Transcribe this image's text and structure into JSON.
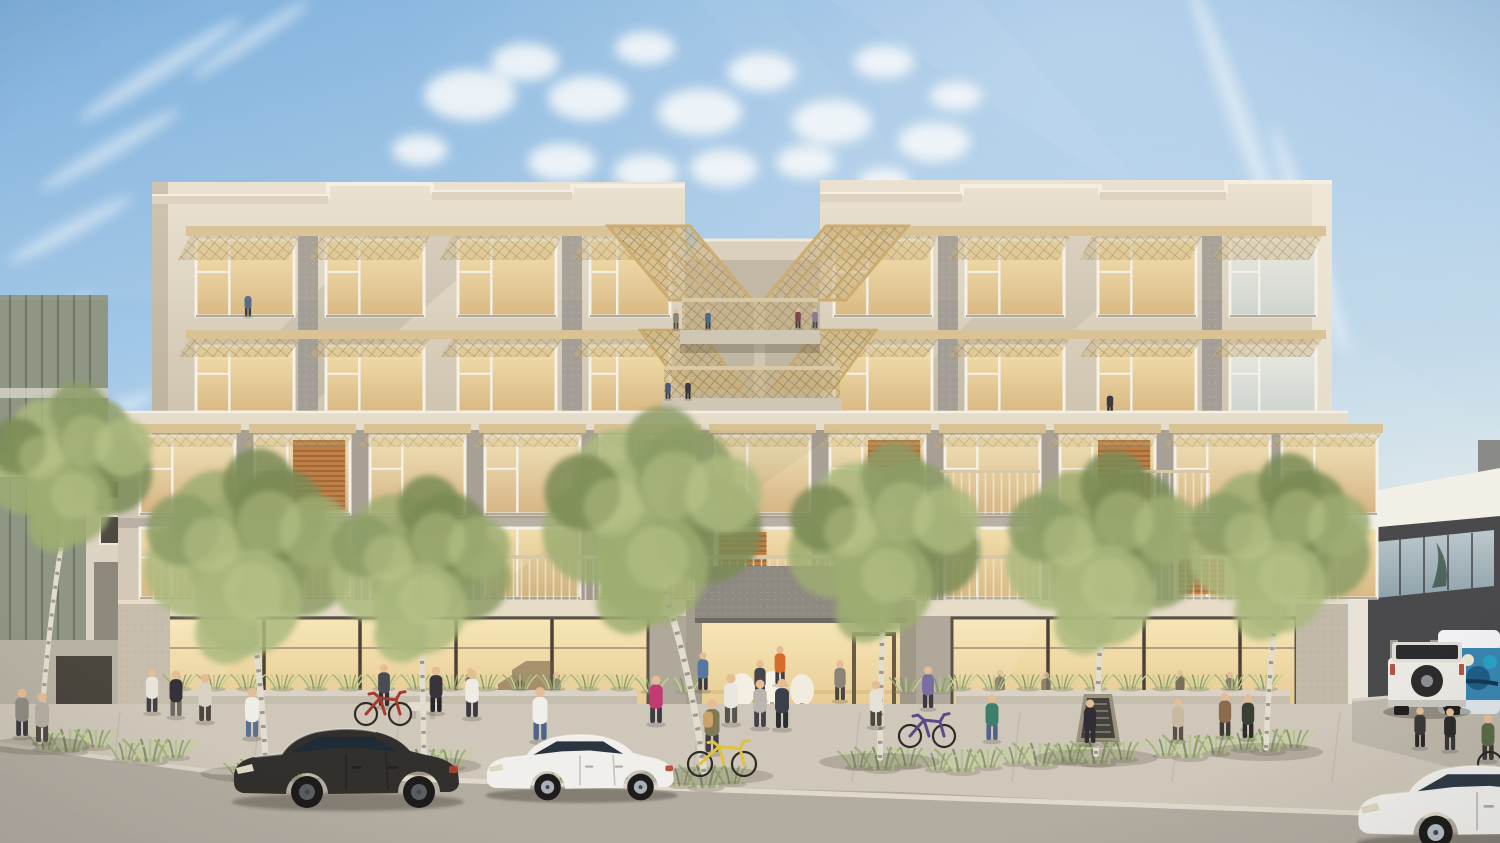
{
  "meta": {
    "caption": "Street-level architectural rendering of a modern five-story mixed-use apartment building with street trees, pedestrians, cyclists and parked cars",
    "width": 1500,
    "height": 843
  },
  "palette": {
    "sky_top": "#74abdc",
    "sky_mid": "#a5c9e8",
    "sky_horizon": "#e9e2d4",
    "cloud": "#f8fbfd",
    "beige_light": "#e9e1d1",
    "beige": "#d6cab6",
    "beige_shade": "#c3b7a2",
    "gray_panel": "#a49f96",
    "gray_dark": "#8e8980",
    "podium": "#a8a095",
    "awning_tan": "#d9c294",
    "mesh_tan": "#c9b17c",
    "frame_white": "#f4f1e8",
    "window_warm_hi": "#f2dfae",
    "window_warm_lo": "#d9b983",
    "wood_louver": "#bf7f46",
    "storefront_glow": "#f6e3b0",
    "sidewalk": "#cfc7b9",
    "road": "#b3aca1",
    "curb": "#e0d9cb",
    "tree_greens": [
      "#8c9c66",
      "#9dad72",
      "#7a8b55",
      "#aab87e"
    ],
    "tree_highlight": "#c2cc92",
    "birch_trunk": "#e3ddd0",
    "birch_mark": "#57524a",
    "grass_sage": "#a9ba85",
    "car_black": "#32302d",
    "car_white": "#f0efeb",
    "bike_yellow": "#e0c23c",
    "bike_red": "#a83a2c",
    "bike_purple": "#5b4a8a",
    "van_graffiti": "#3a86b0",
    "neighbor_dark": "#47474a",
    "vest_orange": "#d86a2a"
  },
  "scene": {
    "architecture": {
      "upper_wings": [
        {
          "name": "left-wing",
          "bays": [
            [
              190,
              110
            ],
            [
              320,
              110
            ],
            [
              452,
              110
            ],
            [
              584,
              92
            ]
          ]
        },
        {
          "name": "right-wing",
          "bays": [
            [
              828,
              110
            ],
            [
              960,
              110
            ],
            [
              1092,
              110
            ],
            [
              1224,
              98
            ]
          ]
        }
      ],
      "floor5": {
        "y": 240,
        "h": 76
      },
      "floor4": {
        "y": 346,
        "h": 66
      },
      "podium_bays": [
        140,
        255,
        370,
        485,
        600,
        715,
        830,
        945,
        1060,
        1175,
        1282
      ],
      "bay_w": 95,
      "floor3": {
        "y": 436,
        "h": 78,
        "louvers": [
          1,
          4,
          6,
          8
        ]
      },
      "floor2": {
        "y": 528,
        "h": 70,
        "louvers": [
          2,
          5,
          9
        ]
      },
      "storefronts": [
        [
          168,
          648
        ],
        [
          952,
          1296
        ]
      ]
    },
    "clouds": [
      [
        470,
        95,
        46
      ],
      [
        525,
        62,
        34
      ],
      [
        588,
        98,
        40
      ],
      [
        645,
        48,
        30
      ],
      [
        700,
        112,
        42
      ],
      [
        762,
        72,
        34
      ],
      [
        832,
        122,
        40
      ],
      [
        884,
        62,
        30
      ],
      [
        934,
        142,
        36
      ],
      [
        562,
        162,
        34
      ],
      [
        646,
        172,
        32
      ],
      [
        724,
        168,
        34
      ],
      [
        806,
        162,
        30
      ],
      [
        884,
        182,
        26
      ],
      [
        956,
        96,
        26
      ],
      [
        420,
        150,
        28
      ]
    ],
    "wisps": [
      [
        160,
        70,
        95,
        9,
        -32
      ],
      [
        110,
        150,
        80,
        8,
        -30
      ],
      [
        70,
        230,
        70,
        8,
        -28
      ],
      [
        250,
        40,
        70,
        7,
        -33
      ],
      [
        1240,
        120,
        150,
        10,
        70
      ],
      [
        1310,
        240,
        120,
        9,
        72
      ],
      [
        40,
        320,
        60,
        7,
        -25
      ],
      [
        90,
        420,
        70,
        8,
        -22
      ]
    ],
    "trees": [
      [
        70,
        470,
        84,
        40,
        742,
        0
      ],
      [
        248,
        560,
        106,
        266,
        770,
        1
      ],
      [
        420,
        572,
        92,
        424,
        762,
        0
      ],
      [
        652,
        524,
        112,
        704,
        772,
        1
      ],
      [
        884,
        546,
        98,
        880,
        758,
        0
      ],
      [
        1104,
        556,
        100,
        1096,
        754,
        1
      ],
      [
        1280,
        550,
        92,
        1266,
        748,
        0
      ]
    ],
    "grass_clumps": [
      [
        150,
        762
      ],
      [
        268,
        782
      ],
      [
        425,
        772
      ],
      [
        588,
        782
      ],
      [
        706,
        788
      ],
      [
        882,
        770
      ],
      [
        1040,
        766
      ],
      [
        1098,
        764
      ],
      [
        1190,
        758
      ],
      [
        1268,
        752
      ],
      [
        70,
        752
      ],
      [
        962,
        772
      ],
      [
        330,
        770
      ]
    ],
    "planter_rows": [
      [
        180,
        636,
        689
      ],
      [
        960,
        1288,
        689
      ],
      [
        652,
        698,
        692
      ],
      [
        906,
        948,
        692
      ]
    ],
    "people": [
      [
        22,
        736,
        50,
        "#8f8c84",
        "#3d3c40"
      ],
      [
        42,
        742,
        52,
        "#b5afa2",
        "#514c46"
      ],
      [
        152,
        712,
        46,
        "#e9e4da",
        "#403f45"
      ],
      [
        176,
        716,
        48,
        "#33323a",
        "#6e6960"
      ],
      [
        205,
        721,
        50,
        "#d9d2c3",
        "#4b4641"
      ],
      [
        252,
        737,
        52,
        "#f0ede5",
        "#5b7191"
      ],
      [
        436,
        712,
        48,
        "#37343c",
        "#26262c"
      ],
      [
        472,
        717,
        50,
        "#efece5",
        "#3b3b41"
      ],
      [
        540,
        740,
        56,
        "#f1efe9",
        "#50648a"
      ],
      [
        656,
        723,
        50,
        "#c23a72",
        "#3d3b43"
      ],
      [
        731,
        723,
        52,
        "#eae7e0",
        "#57544e"
      ],
      [
        760,
        727,
        50,
        "#b9b5ad",
        "#45434b"
      ],
      [
        782,
        728,
        52,
        "#3b404b",
        "#2c2e34"
      ],
      [
        876,
        726,
        48,
        "#e5e1d7",
        "#4b4841"
      ],
      [
        992,
        740,
        48,
        "#3f7d6d",
        "#50648a"
      ],
      [
        1090,
        743,
        46,
        "#302e34",
        "#302e34"
      ],
      [
        1178,
        740,
        44,
        "#cab9a1",
        "#5b5149"
      ],
      [
        1225,
        736,
        46,
        "#8b6b4b",
        "#403b36"
      ],
      [
        1248,
        738,
        46,
        "#3b4036",
        "#2d2b29"
      ],
      [
        1420,
        747,
        42,
        "#3d3b39",
        "#2b2a28"
      ],
      [
        1450,
        750,
        44,
        "#2f2d2b",
        "#3b3937"
      ],
      [
        1488,
        760,
        48,
        "#5b6b46",
        "#3d3b39"
      ]
    ],
    "lobby_people": [
      [
        703,
        690,
        40,
        "#5577a0",
        "#3b3b41"
      ],
      [
        760,
        700,
        42,
        "#46454c",
        "#35333b"
      ],
      [
        780,
        684,
        40,
        "#d86a2a",
        "#403e45"
      ],
      [
        840,
        700,
        42,
        "#8a8578",
        "#4a4640"
      ]
    ],
    "interior_people": [
      [
        520,
        708,
        36,
        "#6b6357",
        "#554e44"
      ],
      [
        556,
        706,
        36,
        "#7a7163",
        "#5a5349"
      ],
      [
        470,
        700,
        34,
        "#5e564b",
        "#4a443c"
      ],
      [
        1000,
        704,
        36,
        "#6b6357",
        "#554e44"
      ],
      [
        1046,
        706,
        36,
        "#7a7163",
        "#5a5349"
      ],
      [
        1180,
        702,
        34,
        "#60584d",
        "#4b453d"
      ],
      [
        1230,
        704,
        34,
        "#6e6559",
        "#565046"
      ]
    ],
    "bridge_people": [
      [
        676,
        329,
        21,
        "#8a8578",
        "#4a4640"
      ],
      [
        708,
        329,
        21,
        "#4a6a8a",
        "#3a3a40"
      ],
      [
        798,
        328,
        21,
        "#7a4a4a",
        "#3a3a40"
      ],
      [
        815,
        328,
        21,
        "#8a7a9a",
        "#45434b"
      ],
      [
        668,
        399,
        21,
        "#4a5a7a",
        "#3a3a42"
      ],
      [
        688,
        399,
        21,
        "#3a3a42",
        "#2c2a30"
      ]
    ],
    "window_people": [
      [
        248,
        316,
        26,
        "#5a6a8a",
        "#3c3c42"
      ],
      [
        1025,
        506,
        30,
        "#6a7a5a",
        "#3f3d43"
      ],
      [
        1142,
        508,
        26,
        "#8a5a4a",
        "#3e3a38"
      ],
      [
        1110,
        414,
        24,
        "#3c3a40",
        "#2c2a30"
      ]
    ],
    "cyclists": [
      {
        "rider": [
          384,
          706,
          44,
          "#4b4b52",
          "#303036"
        ],
        "bike": [
          366,
          400,
          714,
          11,
          "#a83a2c"
        ]
      },
      {
        "rider": [
          928,
          708,
          44,
          "#7a6ea0",
          "#3c3a42"
        ],
        "bike": [
          910,
          944,
          736,
          11,
          "#5b4a8a"
        ]
      }
    ],
    "walked_bike": {
      "rider": [
        712,
        752,
        56,
        "#7d7a55",
        "#3f3d45"
      ],
      "bike": [
        700,
        744,
        764,
        12,
        "#e0c23c"
      ]
    },
    "vehicles": [
      {
        "id": "sedan-black",
        "kind": "sedan",
        "x": 228,
        "y": 716,
        "s": 1.0,
        "body": "#32302d",
        "glass": "#202b38",
        "rim": "#5a5e64"
      },
      {
        "id": "sedan-white",
        "kind": "sedan",
        "x": 482,
        "y": 724,
        "s": 0.83,
        "body": "#f0efeb",
        "glass": "#2b3540",
        "rim": "#aab0b8"
      },
      {
        "id": "sedan-white-right",
        "kind": "sedan",
        "x": 1352,
        "y": 752,
        "s": 1.06,
        "body": "#f1f0ec",
        "glass": "#2f3a44",
        "rim": "#b8bec6"
      }
    ],
    "chalkboard": {
      "x": 1080,
      "y": 694
    },
    "bench": {
      "x": 408,
      "y": 702
    }
  }
}
